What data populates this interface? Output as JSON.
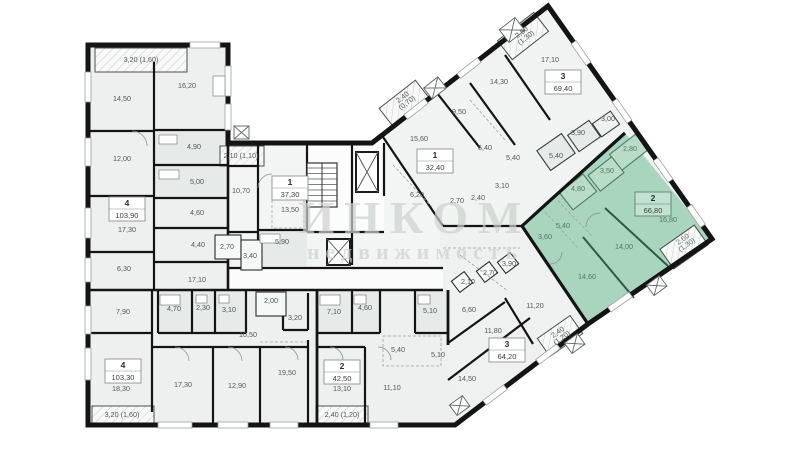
{
  "watermark": {
    "line1": "ИНКОМ",
    "line2": "недвижимость"
  },
  "colors": {
    "highlight_fill": "#a9d4be",
    "highlight_room_fill": "#b9dcc9",
    "highlight_wall": "#2d5a42",
    "wall": "#141414",
    "room_fill": "#edf0ee",
    "label_text": "#4e5955"
  },
  "apartments": [
    {
      "id": "apt-4-left",
      "number": "4",
      "area": "103,90",
      "box": {
        "x": 127,
        "y": 209
      },
      "highlighted": false,
      "rooms": [
        {
          "v": "3,20 (1,60)",
          "x": 141,
          "y": 62,
          "s": 6.2
        },
        {
          "v": "14,50",
          "x": 122,
          "y": 101
        },
        {
          "v": "16,20",
          "x": 187,
          "y": 88
        },
        {
          "v": "12,00",
          "x": 122,
          "y": 161
        },
        {
          "v": "4,90",
          "x": 194,
          "y": 149
        },
        {
          "v": "5,00",
          "x": 197,
          "y": 184
        },
        {
          "v": "4,60",
          "x": 197,
          "y": 215
        },
        {
          "v": "17,30",
          "x": 127,
          "y": 232
        },
        {
          "v": "4,40",
          "x": 198,
          "y": 247
        },
        {
          "v": "6,30",
          "x": 124,
          "y": 271
        },
        {
          "v": "17,10",
          "x": 197,
          "y": 282
        }
      ]
    },
    {
      "id": "apt-1-center",
      "number": "1",
      "area": "37,30",
      "box": {
        "x": 290,
        "y": 188
      },
      "highlighted": false,
      "rooms": [
        {
          "v": "2,10 (1,10)",
          "x": 241,
          "y": 158,
          "s": 6.0
        },
        {
          "v": "10,70",
          "x": 241,
          "y": 193
        },
        {
          "v": "13,50",
          "x": 290,
          "y": 212
        },
        {
          "v": "5,90",
          "x": 282,
          "y": 244
        },
        {
          "v": "2,70",
          "x": 227,
          "y": 249
        },
        {
          "v": "3,40",
          "x": 250,
          "y": 258
        }
      ]
    },
    {
      "id": "apt-1-right",
      "number": "1",
      "area": "32,40",
      "box": {
        "x": 435,
        "y": 161
      },
      "highlighted": false,
      "rooms": [
        {
          "v": "2,40",
          "l2": "(0,70)",
          "x": 404,
          "y": 99,
          "r": -38,
          "s": 6.0
        },
        {
          "v": "15,60",
          "x": 419,
          "y": 141
        },
        {
          "v": "9,50",
          "x": 459,
          "y": 114
        },
        {
          "v": "6,20",
          "x": 417,
          "y": 197
        }
      ]
    },
    {
      "id": "apt-3-top",
      "number": "3",
      "area": "69,40",
      "box": {
        "x": 563,
        "y": 82
      },
      "highlighted": false,
      "rooms": [
        {
          "v": "2,50",
          "l2": "(1,30)",
          "x": 523,
          "y": 34,
          "r": -38,
          "s": 6.0
        },
        {
          "v": "17,10",
          "x": 550,
          "y": 62
        },
        {
          "v": "14,30",
          "x": 499,
          "y": 84
        },
        {
          "v": "6,40",
          "x": 485,
          "y": 150
        },
        {
          "v": "5,40",
          "x": 513,
          "y": 160
        },
        {
          "v": "5,40",
          "x": 556,
          "y": 158
        },
        {
          "v": "3,10",
          "x": 502,
          "y": 188
        },
        {
          "v": "2,40",
          "x": 478,
          "y": 200
        },
        {
          "v": "2,70",
          "x": 457,
          "y": 203
        },
        {
          "v": "3,90",
          "x": 578,
          "y": 135
        },
        {
          "v": "3,00",
          "x": 608,
          "y": 121
        }
      ]
    },
    {
      "id": "apt-2-green",
      "number": "2",
      "area": "66,80",
      "box": {
        "x": 653,
        "y": 204
      },
      "highlighted": true,
      "rooms": [
        {
          "v": "2,80",
          "x": 630,
          "y": 151
        },
        {
          "v": "3,50",
          "x": 607,
          "y": 173
        },
        {
          "v": "4,80",
          "x": 578,
          "y": 191
        },
        {
          "v": "5,40",
          "x": 563,
          "y": 228
        },
        {
          "v": "3,60",
          "x": 545,
          "y": 239
        },
        {
          "v": "16,80",
          "x": 668,
          "y": 222
        },
        {
          "v": "14,00",
          "x": 624,
          "y": 249
        },
        {
          "v": "14,60",
          "x": 587,
          "y": 279
        },
        {
          "v": "2,60",
          "l2": "(1,30)",
          "x": 684,
          "y": 241,
          "r": -35,
          "s": 6.0
        }
      ]
    },
    {
      "id": "apt-4-bottom",
      "number": "4",
      "area": "103,30",
      "box": {
        "x": 123,
        "y": 371
      },
      "highlighted": false,
      "rooms": [
        {
          "v": "7,90",
          "x": 123,
          "y": 314
        },
        {
          "v": "4,70",
          "x": 174,
          "y": 311
        },
        {
          "v": "2,30",
          "x": 203,
          "y": 310
        },
        {
          "v": "3,10",
          "x": 229,
          "y": 312
        },
        {
          "v": "2,00",
          "x": 271,
          "y": 303
        },
        {
          "v": "10,50",
          "x": 248,
          "y": 337
        },
        {
          "v": "3,20",
          "x": 295,
          "y": 320
        },
        {
          "v": "18,30",
          "x": 121,
          "y": 391
        },
        {
          "v": "17,30",
          "x": 183,
          "y": 387
        },
        {
          "v": "12,90",
          "x": 237,
          "y": 388
        },
        {
          "v": "19,50",
          "x": 287,
          "y": 375
        },
        {
          "v": "3,20 (1,60)",
          "x": 122,
          "y": 417,
          "s": 6.0
        }
      ]
    },
    {
      "id": "apt-2-bottom",
      "number": "2",
      "area": "42,50",
      "box": {
        "x": 342,
        "y": 372
      },
      "highlighted": false,
      "rooms": [
        {
          "v": "7,10",
          "x": 334,
          "y": 314
        },
        {
          "v": "4,60",
          "x": 365,
          "y": 310
        },
        {
          "v": "5,40",
          "x": 398,
          "y": 352
        },
        {
          "v": "13,10",
          "x": 342,
          "y": 391
        },
        {
          "v": "11,10",
          "x": 392,
          "y": 390
        },
        {
          "v": "2,40 (1,20)",
          "x": 342,
          "y": 417,
          "s": 6.0
        }
      ]
    },
    {
      "id": "apt-3-bottom",
      "number": "3",
      "area": "64,20",
      "box": {
        "x": 507,
        "y": 350
      },
      "highlighted": false,
      "rooms": [
        {
          "v": "2,10",
          "x": 468,
          "y": 284
        },
        {
          "v": "2,70",
          "x": 490,
          "y": 275
        },
        {
          "v": "3,90",
          "x": 509,
          "y": 266
        },
        {
          "v": "6,60",
          "x": 469,
          "y": 312
        },
        {
          "v": "5,10",
          "x": 430,
          "y": 313
        },
        {
          "v": "5,10",
          "x": 438,
          "y": 357
        },
        {
          "v": "11,80",
          "x": 493,
          "y": 333
        },
        {
          "v": "11,20",
          "x": 535,
          "y": 308
        },
        {
          "v": "14,50",
          "x": 467,
          "y": 381
        },
        {
          "v": "2,40",
          "l2": "(1,20)",
          "x": 559,
          "y": 334,
          "r": -35,
          "s": 6.0
        }
      ]
    }
  ]
}
